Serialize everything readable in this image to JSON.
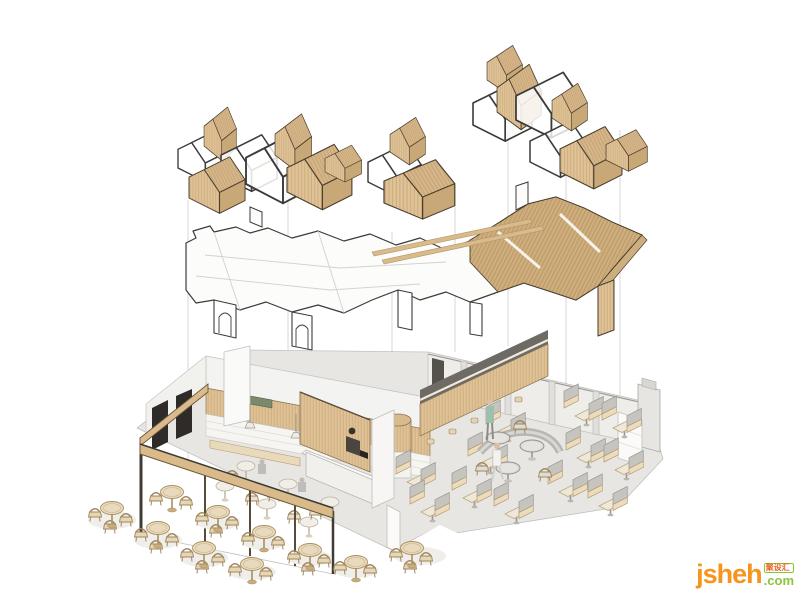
{
  "image": {
    "title": "Restaurant interior design — exploded axonometric diagram",
    "background": "#ffffff"
  },
  "layers": [
    {
      "id": "concept-volumes",
      "label": "House-shaped concept volumes"
    },
    {
      "id": "ceiling-plan",
      "label": "Ceiling plan with wood slat canopy"
    },
    {
      "id": "floor-plan",
      "label": "Furnished floor plan with terrace"
    }
  ],
  "watermark": {
    "brand": "jsheh",
    "cjk": "聚设汇",
    "tld": ".com"
  },
  "colors": {
    "bg": "#ffffff",
    "outline": "#3b3b3b",
    "wood": "#ddbf92",
    "wood-mid": "#d2b283",
    "wood-dark": "#c9a877",
    "wood-edge": "#6b573c",
    "floor": "#e7e6e3",
    "wall": "#eeedea",
    "wall-edge": "#c2c1be",
    "bench": "#ecdcbd",
    "bench-edge": "#b49c72",
    "guide": "#d8d7d4",
    "teal": "#9fbfae",
    "skin": "#d9c0a8",
    "wm-orange": "#f7941e",
    "wm-green": "#8bc53f",
    "wm-red": "#e8641e"
  }
}
